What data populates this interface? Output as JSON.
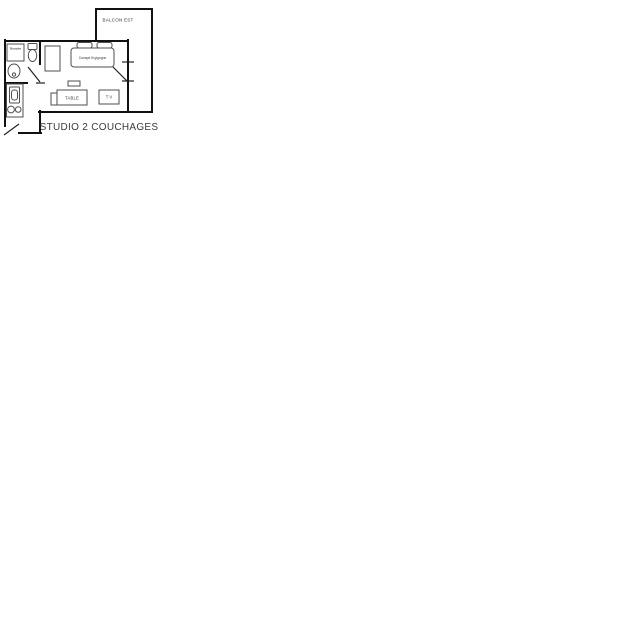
{
  "plan": {
    "title": "STUDIO 2 COUCHAGES",
    "balcony": {
      "label": "BALCON EST"
    },
    "bathroom": {
      "shower_label": "Douche"
    },
    "living_room": {
      "sofa_label": "Canapé lit gigogne",
      "table_label": "TABLE",
      "tv_label": "T V"
    },
    "colors": {
      "wall": "#111111",
      "door": "#222222",
      "furniture_outline": "#4f4f4f",
      "label_text": "#3a3a3a",
      "background": "#ffffff"
    }
  }
}
